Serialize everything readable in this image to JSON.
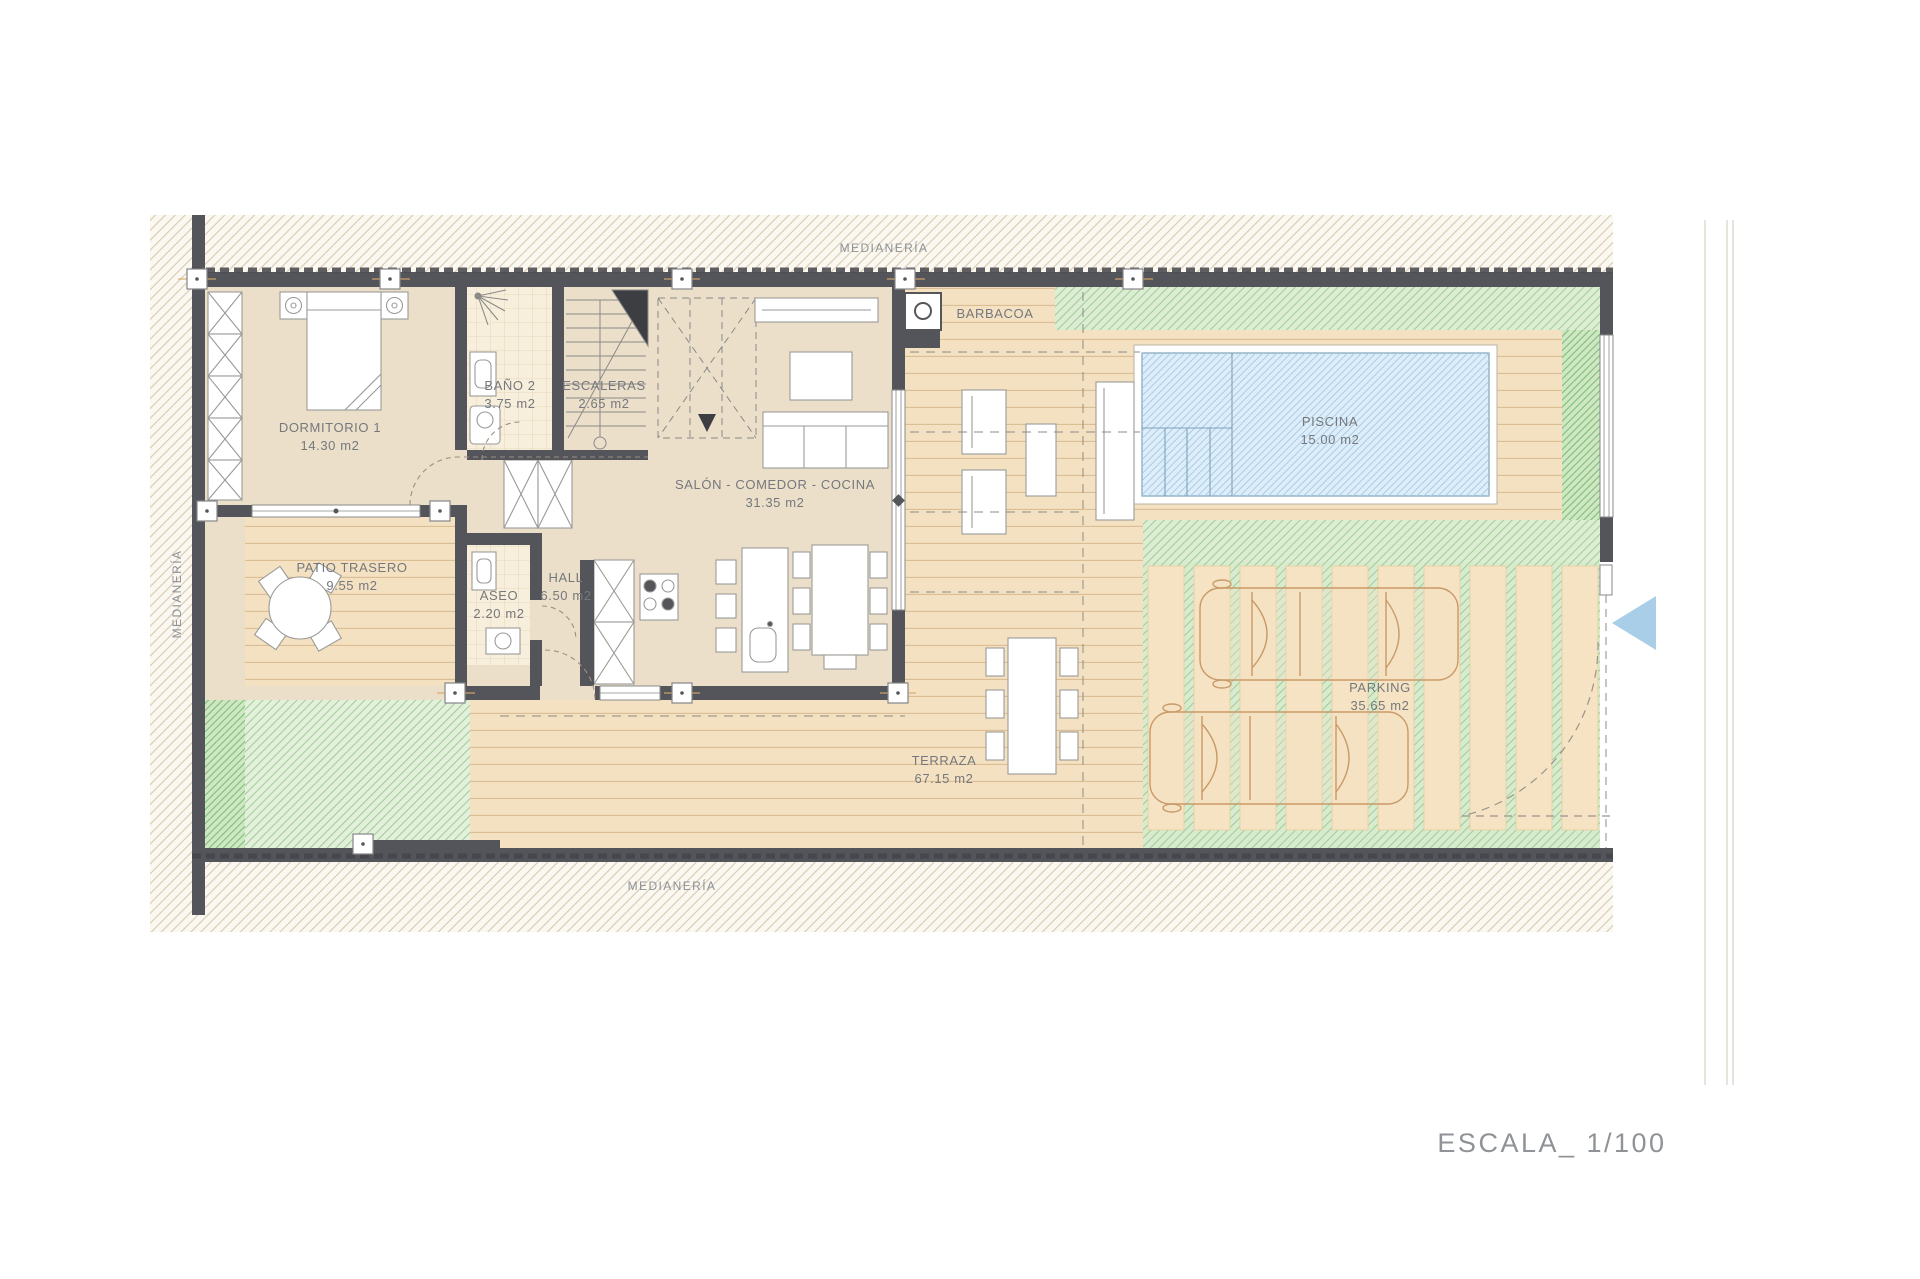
{
  "page": {
    "scale_label": "ESCALA_ 1/100"
  },
  "plan": {
    "boundary_labels": {
      "top": "MEDIANERÍA",
      "bottom": "MEDIANERÍA",
      "left": "MEDIANERÍA"
    },
    "rooms": [
      {
        "id": "dormitorio-1",
        "name": "DORMITORIO 1",
        "area": "14.30 m2"
      },
      {
        "id": "bano-2",
        "name": "BAÑO 2",
        "area": "3.75 m2"
      },
      {
        "id": "escaleras",
        "name": "ESCALERAS",
        "area": "2.65 m2"
      },
      {
        "id": "salon-comedor-cocina",
        "name": "SALÓN - COMEDOR - COCINA",
        "area": "31.35 m2"
      },
      {
        "id": "patio-trasero",
        "name": "PATIO TRASERO",
        "area": "9.55 m2"
      },
      {
        "id": "aseo",
        "name": "ASEO",
        "area": "2.20 m2"
      },
      {
        "id": "hall",
        "name": "HALL",
        "area": "6.50 m2"
      },
      {
        "id": "terraza",
        "name": "TERRAZA",
        "area": "67.15 m2"
      },
      {
        "id": "piscina",
        "name": "PISCINA",
        "area": "15.00 m2"
      },
      {
        "id": "parking",
        "name": "PARKING",
        "area": "35.65 m2"
      }
    ],
    "features": {
      "barbacoa": "BARBACOA"
    },
    "colors": {
      "wall": "#54555a",
      "floor": "#ecdfca",
      "deck": "#f3e1c2",
      "garden_green": "#dcedd3",
      "pool_blue": "#ddeefa",
      "entry_arrow": "#a9cee8"
    }
  }
}
